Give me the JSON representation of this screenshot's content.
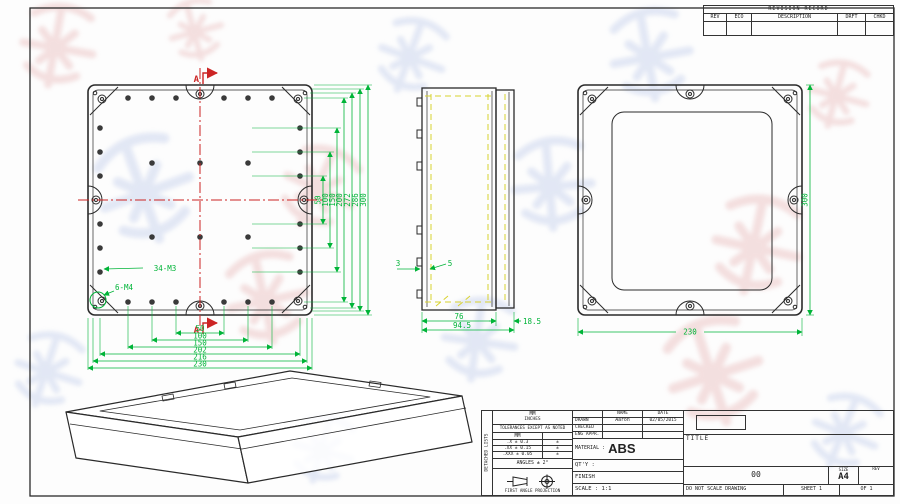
{
  "colors": {
    "line": "#2a2a2a",
    "dim_green": "#00b438",
    "mark_red": "#cc2424",
    "hidden_yellow": "#d8d22e",
    "wm_pink": "#ecc6c6",
    "wm_blue": "#ccd6ee"
  },
  "revision_table": {
    "title": "REVISION RECORD",
    "columns": {
      "rev": "REV",
      "eco": "ECO",
      "description": "DESCRIPTION",
      "drft": "DRFT",
      "chkd": "CHKD"
    }
  },
  "front_view": {
    "section_label": "A",
    "callout_small_holes": "34-M3",
    "callout_corner_holes": "6-M4",
    "dims_vertical": [
      "50",
      "100",
      "150",
      "200",
      "272",
      "286",
      "300"
    ],
    "dims_horizontal": [
      "50",
      "100",
      "150",
      "202",
      "216",
      "230"
    ]
  },
  "side_view": {
    "dim_wall": "3",
    "dim_boss": "5",
    "dim_body": "76",
    "dim_overall": "94.5",
    "dim_lid": "18.5"
  },
  "rear_view": {
    "dim_width": "230",
    "dim_height": "300"
  },
  "title_block": {
    "side_label": "DETACHED LISTS",
    "units_label": "MM",
    "units_sub": "INCHES",
    "tolerance_note": "TOLERANCES EXCEPT AS NOTED",
    "tol_header": "MM",
    "tolerances": [
      {
        "mm": ".X ± 0.3",
        "alt": "±"
      },
      {
        "mm": ".XX ± 0.15",
        "alt": "±"
      },
      {
        "mm": ".XXX ± 0.05",
        "alt": "±"
      }
    ],
    "angles": "ANGLES ± 2°",
    "projection": "FIRST ANGLE PROJECTION",
    "name_header": "NAME",
    "date_header": "DATE",
    "rows": [
      {
        "label": "DRAWN",
        "name": "Aaron",
        "date": "02/05/2015"
      },
      {
        "label": "CHECKED",
        "name": "",
        "date": ""
      },
      {
        "label": "ENG APPR.",
        "name": "",
        "date": ""
      }
    ],
    "material_label": "MATERIAL :",
    "material_value": "ABS",
    "qty_label": "QT'Y :",
    "finish_label": "FINISH",
    "scale_label": "SCALE : 1:1",
    "title_label": "TITLE",
    "drawing_number": "00",
    "size_label": "SIZE",
    "size_value": "A4",
    "rev_label": "REV",
    "do_not_scale": "DO NOT SCALE DRAWING",
    "sheet_label": "SHEET 1",
    "of_label": "OF 1"
  }
}
